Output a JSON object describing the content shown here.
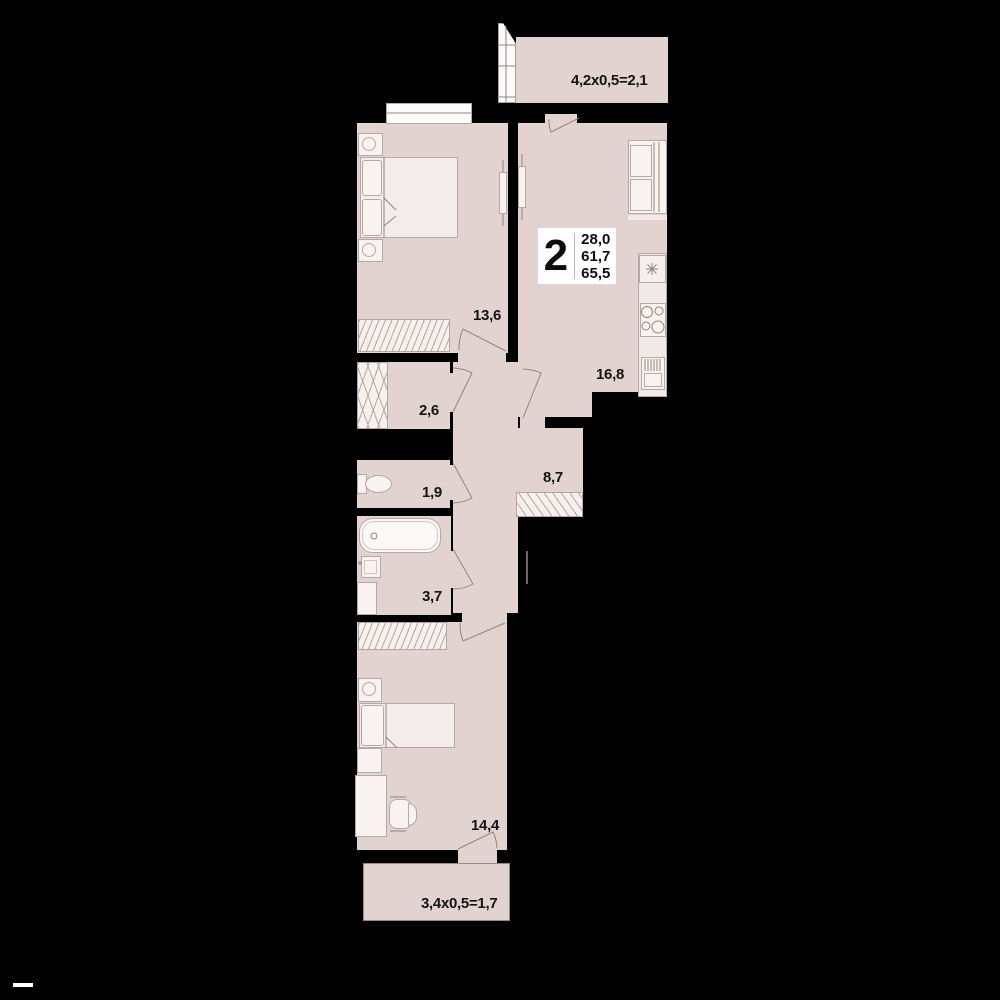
{
  "plan": {
    "info_box": {
      "room_count": "2",
      "area_lines": [
        "28,0",
        "61,7",
        "65,5"
      ]
    },
    "rooms": {
      "living_kitchen": {
        "area": "16,8"
      },
      "bedroom_top": {
        "area": "13,6"
      },
      "storage": {
        "area": "2,6"
      },
      "wc": {
        "area": "1,9"
      },
      "hall": {
        "area": "8,7"
      },
      "bathroom": {
        "area": "3,7"
      },
      "bedroom_bottom": {
        "area": "14,4"
      }
    },
    "balconies": {
      "top": {
        "label": "4,2x0,5=2,1"
      },
      "bottom": {
        "label": "3,4x0,5=1,7"
      }
    }
  },
  "colors": {
    "background": "#000000",
    "floor": "#e2d3d0",
    "fixture": "#f8f3f1",
    "fixture_border": "#b4a9a6",
    "label": "#141414",
    "info_box_bg": "#ffffff"
  }
}
